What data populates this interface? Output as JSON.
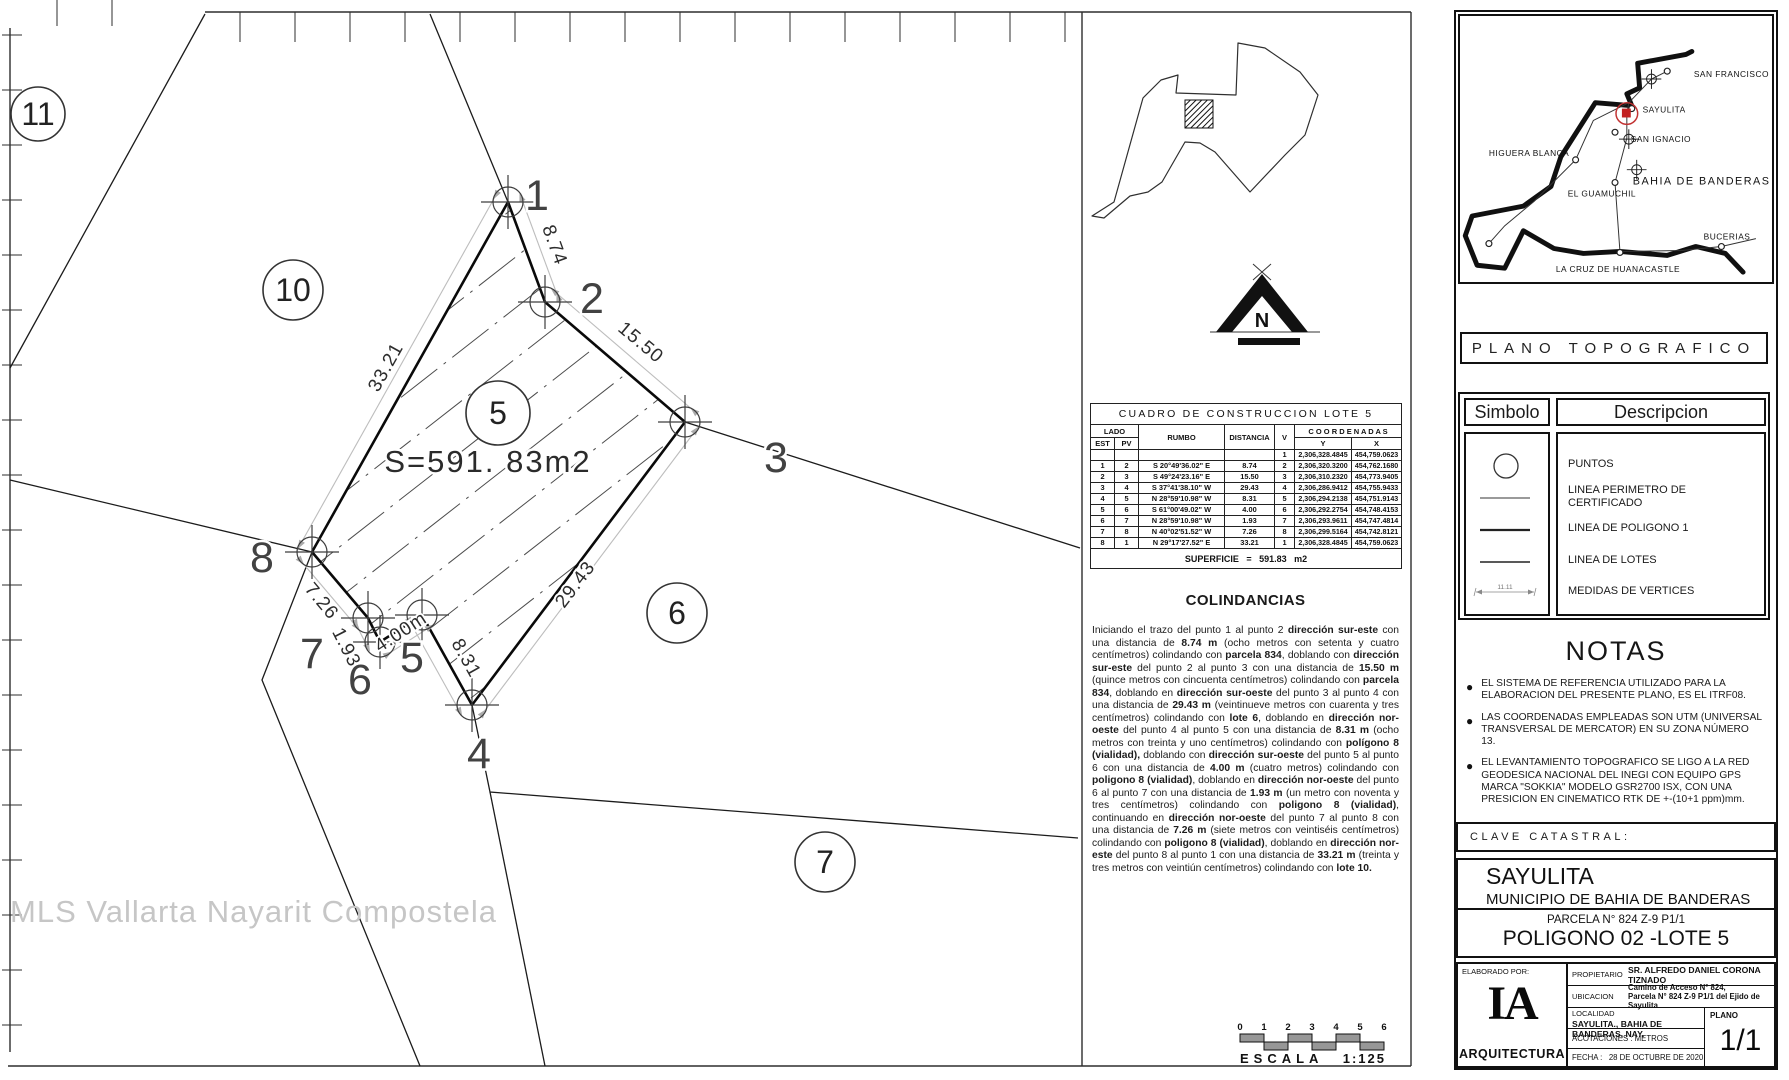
{
  "drawing": {
    "watermark": "MLS Vallarta Nayarit Compostela",
    "area_label": "S=591. 83m2",
    "area_label_pos": {
      "x": 488,
      "y": 472
    },
    "lot5_polygon": [
      [
        508,
        202
      ],
      [
        545,
        302
      ],
      [
        685,
        422
      ],
      [
        472,
        705
      ],
      [
        422,
        615
      ],
      [
        380,
        642
      ],
      [
        368,
        618
      ],
      [
        312,
        552
      ]
    ],
    "boundary_lines": [
      [
        [
          205,
          14
        ],
        [
          10,
          368
        ]
      ],
      [
        [
          430,
          14
        ],
        [
          508,
          202
        ]
      ],
      [
        [
          685,
          422
        ],
        [
          1080,
          548
        ]
      ],
      [
        [
          472,
          705
        ],
        [
          490,
          792
        ],
        [
          1078,
          838
        ]
      ],
      [
        [
          490,
          792
        ],
        [
          545,
          1066
        ]
      ],
      [
        [
          312,
          552
        ],
        [
          262,
          680
        ],
        [
          420,
          1066
        ]
      ],
      [
        [
          312,
          552
        ],
        [
          10,
          480
        ]
      ]
    ],
    "dim_lines": [
      [
        [
          521,
          197
        ],
        [
          558,
          297
        ]
      ],
      [
        [
          554,
          291
        ],
        [
          694,
          411
        ]
      ],
      [
        [
          696,
          430
        ],
        [
          483,
          713
        ]
      ],
      [
        [
          460,
          712
        ],
        [
          410,
          622
        ]
      ],
      [
        [
          430,
          627
        ],
        [
          388,
          654
        ]
      ],
      [
        [
          368,
          648
        ],
        [
          356,
          624
        ]
      ],
      [
        [
          357,
          627
        ],
        [
          301,
          561
        ]
      ],
      [
        [
          300,
          545
        ],
        [
          496,
          195
        ]
      ]
    ],
    "lot_circles": [
      {
        "label": "11",
        "x": 38,
        "y": 114,
        "r": 27
      },
      {
        "label": "10",
        "x": 293,
        "y": 290,
        "r": 30
      },
      {
        "label": "5",
        "x": 498,
        "y": 413,
        "r": 32
      },
      {
        "label": "6",
        "x": 677,
        "y": 613,
        "r": 30
      },
      {
        "label": "7",
        "x": 825,
        "y": 862,
        "r": 30
      }
    ],
    "vertex_labels": [
      {
        "label": "1",
        "x": 537,
        "y": 210
      },
      {
        "label": "2",
        "x": 592,
        "y": 313
      },
      {
        "label": "3",
        "x": 776,
        "y": 472
      },
      {
        "label": "4",
        "x": 479,
        "y": 768
      },
      {
        "label": "5",
        "x": 412,
        "y": 672
      },
      {
        "label": "6",
        "x": 360,
        "y": 694
      },
      {
        "label": "7",
        "x": 312,
        "y": 668
      },
      {
        "label": "8",
        "x": 262,
        "y": 572
      }
    ],
    "dim_labels": [
      {
        "label": "8.74",
        "x": 549,
        "y": 247,
        "rot": 70
      },
      {
        "label": "15.50",
        "x": 637,
        "y": 347,
        "rot": 40
      },
      {
        "label": "29.43",
        "x": 580,
        "y": 588,
        "rot": -53
      },
      {
        "label": "8.31",
        "x": 461,
        "y": 661,
        "rot": 61
      },
      {
        "label": "4.00m",
        "x": 404,
        "y": 637,
        "rot": -33
      },
      {
        "label": "1.93",
        "x": 341,
        "y": 650,
        "rot": 63
      },
      {
        "label": "7.26",
        "x": 317,
        "y": 605,
        "rot": 50
      },
      {
        "label": "33.21",
        "x": 391,
        "y": 370,
        "rot": -61
      }
    ]
  },
  "locator": {
    "polygon": [
      [
        1092,
        216
      ],
      [
        1114,
        202
      ],
      [
        1143,
        98
      ],
      [
        1161,
        80
      ],
      [
        1178,
        75
      ],
      [
        1176,
        93
      ],
      [
        1236,
        95
      ],
      [
        1238,
        43
      ],
      [
        1265,
        48
      ],
      [
        1300,
        72
      ],
      [
        1318,
        95
      ],
      [
        1305,
        135
      ],
      [
        1285,
        155
      ],
      [
        1250,
        192
      ],
      [
        1215,
        152
      ],
      [
        1200,
        143
      ],
      [
        1185,
        142
      ],
      [
        1162,
        182
      ],
      [
        1148,
        192
      ],
      [
        1130,
        196
      ],
      [
        1104,
        218
      ]
    ],
    "square": [
      1185,
      100,
      28
    ]
  },
  "north": {
    "label": "N"
  },
  "construction_table": {
    "title": "CUADRO DE CONSTRUCCION LOTE 5",
    "headers": {
      "lado": "LADO",
      "est": "EST",
      "pv": "PV",
      "rumbo": "RUMBO",
      "distancia": "DISTANCIA",
      "v": "V",
      "coordenadas": "C O O R D E N A D A S",
      "y": "Y",
      "x": "X"
    },
    "rows": [
      {
        "est": "",
        "pv": "",
        "rumbo": "",
        "dist": "",
        "v": "1",
        "y": "2,306,328.4845",
        "x": "454,759.0623"
      },
      {
        "est": "1",
        "pv": "2",
        "rumbo": "S 20°49'36.02\" E",
        "dist": "8.74",
        "v": "2",
        "y": "2,306,320.3200",
        "x": "454,762.1680"
      },
      {
        "est": "2",
        "pv": "3",
        "rumbo": "S 49°24'23.16\" E",
        "dist": "15.50",
        "v": "3",
        "y": "2,306,310.2320",
        "x": "454,773.9405"
      },
      {
        "est": "3",
        "pv": "4",
        "rumbo": "S 37°41'38.10\" W",
        "dist": "29.43",
        "v": "4",
        "y": "2,306,286.9412",
        "x": "454,755.9433"
      },
      {
        "est": "4",
        "pv": "5",
        "rumbo": "N 28°59'10.98\" W",
        "dist": "8.31",
        "v": "5",
        "y": "2,306,294.2138",
        "x": "454,751.9143"
      },
      {
        "est": "5",
        "pv": "6",
        "rumbo": "S 61°00'49.02\" W",
        "dist": "4.00",
        "v": "6",
        "y": "2,306,292.2754",
        "x": "454,748.4153"
      },
      {
        "est": "6",
        "pv": "7",
        "rumbo": "N 28°59'10.98\" W",
        "dist": "1.93",
        "v": "7",
        "y": "2,306,293.9611",
        "x": "454,747.4814"
      },
      {
        "est": "7",
        "pv": "8",
        "rumbo": "N 40°02'51.52\" W",
        "dist": "7.26",
        "v": "8",
        "y": "2,306,299.5164",
        "x": "454,742.8121"
      },
      {
        "est": "8",
        "pv": "1",
        "rumbo": "N 29°17'27.52\" E",
        "dist": "33.21",
        "v": "1",
        "y": "2,306,328.4845",
        "x": "454,759.0623"
      }
    ],
    "superficie": "SUPERFICIE = 591.83 m2"
  },
  "colindancias": {
    "title": "COLINDANCIAS",
    "segments": [
      {
        "t": "Iniciando el trazo del punto 1 al punto 2 "
      },
      {
        "t": "dirección sur-este",
        "b": 1
      },
      {
        "t": " con una distancia de "
      },
      {
        "t": "8.74 m",
        "b": 1
      },
      {
        "t": " (ocho metros con setenta y cuatro centímetros) colindando con "
      },
      {
        "t": "parcela 834",
        "b": 1
      },
      {
        "t": ", doblando con "
      },
      {
        "t": "dirección sur-este",
        "b": 1
      },
      {
        "t": " del punto 2 al punto 3 con una distancia de "
      },
      {
        "t": "15.50 m",
        "b": 1
      },
      {
        "t": " (quince metros con cincuenta centímetros) colindando con "
      },
      {
        "t": "parcela 834",
        "b": 1
      },
      {
        "t": ", doblando en "
      },
      {
        "t": "dirección sur-oeste",
        "b": 1
      },
      {
        "t": " del punto 3 al punto 4 con una distancia de "
      },
      {
        "t": "29.43 m",
        "b": 1
      },
      {
        "t": " (veintinueve metros con cuarenta y tres centímetros) colindando con "
      },
      {
        "t": "lote 6",
        "b": 1
      },
      {
        "t": ", doblando en "
      },
      {
        "t": "dirección nor-oeste",
        "b": 1
      },
      {
        "t": " del punto 4 al punto 5 con una distancia de "
      },
      {
        "t": "8.31 m",
        "b": 1
      },
      {
        "t": " (ocho metros con treinta y uno centímetros) colindando con "
      },
      {
        "t": "polígono 8 (vialidad),",
        "b": 1
      },
      {
        "t": " doblando con "
      },
      {
        "t": "dirección sur-oeste",
        "b": 1
      },
      {
        "t": " del punto 5 al punto 6 con una distancia de "
      },
      {
        "t": "4.00 m",
        "b": 1
      },
      {
        "t": " (cuatro metros) colindando con "
      },
      {
        "t": "poligono 8 (vialidad)",
        "b": 1
      },
      {
        "t": ", doblando en "
      },
      {
        "t": "dirección nor-oeste",
        "b": 1
      },
      {
        "t": " del punto 6 al punto 7 con una distancia de "
      },
      {
        "t": "1.93 m",
        "b": 1
      },
      {
        "t": " (un metro con noventa y tres centímetros) colindando con "
      },
      {
        "t": "poligono 8 (vialidad)",
        "b": 1
      },
      {
        "t": ", continuando en "
      },
      {
        "t": "dirección nor-oeste",
        "b": 1
      },
      {
        "t": " del punto 7 al punto 8 con una distancia de "
      },
      {
        "t": "7.26 m",
        "b": 1
      },
      {
        "t": " (siete metros con veintiséis centímetros) colindando con "
      },
      {
        "t": "poligono 8 (vialidad)",
        "b": 1
      },
      {
        "t": ", doblando en "
      },
      {
        "t": "dirección nor-este",
        "b": 1
      },
      {
        "t": " del punto 8 al punto 1 con una distancia de "
      },
      {
        "t": "33.21 m",
        "b": 1
      },
      {
        "t": " (treinta y tres metros con veintiún centímetros) colindando con "
      },
      {
        "t": "lote 10.",
        "b": 1
      }
    ]
  },
  "scale_bar": {
    "ticks": [
      "0",
      "1",
      "2",
      "3",
      "4",
      "5",
      "6"
    ],
    "escala": "ESCALA",
    "ratio": "1:125"
  },
  "right_panel": {
    "plano_title": "PLANO TOPOGRAFICO",
    "map": {
      "coast": [
        [
          240,
          38
        ],
        [
          234,
          41
        ],
        [
          185,
          50
        ],
        [
          187,
          75
        ],
        [
          174,
          81
        ],
        [
          179,
          93
        ],
        [
          142,
          90
        ],
        [
          107,
          145
        ],
        [
          97,
          175
        ],
        [
          69,
          195
        ],
        [
          17,
          205
        ],
        [
          10,
          225
        ],
        [
          22,
          255
        ],
        [
          50,
          258
        ],
        [
          69,
          220
        ],
        [
          100,
          238
        ],
        [
          130,
          243
        ],
        [
          167,
          241
        ],
        [
          215,
          245
        ],
        [
          244,
          236
        ],
        [
          274,
          243
        ],
        [
          292,
          262
        ]
      ],
      "roads": [
        [
          [
            215,
            58
          ],
          [
            199,
            66
          ],
          [
            176,
            90
          ],
          [
            174,
            101
          ],
          [
            174,
            126
          ],
          [
            162,
            171
          ],
          [
            167,
            241
          ]
        ],
        [
          [
            167,
            241
          ],
          [
            230,
            240
          ],
          [
            270,
            236
          ],
          [
            305,
            228
          ]
        ],
        [
          [
            176,
            90
          ],
          [
            140,
            108
          ],
          [
            122,
            148
          ],
          [
            80,
            190
          ],
          [
            50,
            215
          ],
          [
            34,
            233
          ]
        ]
      ],
      "points": [
        [
          215,
          58
        ],
        [
          179,
          96
        ],
        [
          162,
          120
        ],
        [
          122,
          148
        ],
        [
          162,
          171
        ],
        [
          270,
          236
        ],
        [
          167,
          242
        ],
        [
          34,
          233
        ]
      ],
      "crosshairs": [
        [
          199,
          66
        ],
        [
          176,
          127
        ],
        [
          184,
          158
        ]
      ],
      "red_marker": {
        "x": 174,
        "y": 101
      },
      "towns": [
        {
          "name": "SAN FRANCISCO",
          "lx": 242,
          "ly": 64
        },
        {
          "name": "SAYULITA",
          "lx": 190,
          "ly": 100
        },
        {
          "name": "SAN IGNACIO",
          "lx": 178,
          "ly": 130
        },
        {
          "name": "HIGUERA BLANCA",
          "lx": 34,
          "ly": 144
        },
        {
          "name": "BAHIA DE BANDERAS",
          "lx": 180,
          "ly": 173,
          "big": true
        },
        {
          "name": "EL GUAMUCHIL",
          "lx": 114,
          "ly": 185
        },
        {
          "name": "BUCERIAS",
          "lx": 252,
          "ly": 229
        },
        {
          "name": "LA CRUZ DE HUANACASTLE",
          "lx": 102,
          "ly": 262
        },
        {
          "name": "PUNTA DE MITA",
          "lx": 8,
          "ly": 279
        }
      ]
    },
    "legend": {
      "simbolo": "Simbolo",
      "descripcion": "Descripcion",
      "items": [
        {
          "desc": "PUNTOS",
          "sym": "circle"
        },
        {
          "desc": "LINEA PERIMETRO DE CERTIFICADO",
          "sym": "line-light"
        },
        {
          "desc": "LINEA DE POLIGONO 1",
          "sym": "line-dark"
        },
        {
          "desc": "LINEA DE LOTES",
          "sym": "line-med"
        },
        {
          "desc": "MEDIDAS DE VERTICES",
          "sym": "measure",
          "measure_label": "11.11"
        }
      ]
    },
    "notas": {
      "title": "NOTAS",
      "items": [
        "EL SISTEMA DE REFERENCIA UTILIZADO PARA LA ELABORACION DEL PRESENTE PLANO, ES EL ITRF08.",
        "LAS COORDENADAS EMPLEADAS SON UTM (UNIVERSAL TRANSVERSAL DE MERCATOR) EN SU ZONA NÚMERO 13.",
        "EL  LEVANTAMIENTO TOPOGRAFICO SE LIGO A LA RED GEODESICA NACIONAL DEL INEGI CON EQUIPO GPS MARCA  \"SOKKIA\"  MODELO GSR2700 ISX, CON UNA PRESICION EN CINEMATICO RTK DE +-(10+1 ppm)mm."
      ]
    },
    "clave": "CLAVE  CATASTRAL:",
    "location_block": {
      "line1": "SAYULITA",
      "line2": "MUNICIPIO DE BAHIA DE BANDERAS",
      "line3": "PARCELA N° 824 Z-9 P1/1",
      "line4": "POLIGONO 02 -LOTE 5"
    },
    "title_block": {
      "elaborado": "ELABORADO POR:",
      "logo_main": "IA",
      "logo_sub": "ARQUITECTURA",
      "prop_label": "PROPIETARIO",
      "prop_value": "SR. ALFREDO DANIEL CORONA TIZNADO",
      "ubi_label": "UBICACION",
      "ubi_value1": "Camino de Acceso N° 824,",
      "ubi_value2": "Parcela N° 824 Z-9 P1/1 del Ejido de Sayulita",
      "loc_label": "LOCALIDAD",
      "loc_value": "SAYULITA., BAHIA DE BANDERAS, NAY.",
      "acot": "ACOTACIONES : METROS",
      "fecha_label": "FECHA :",
      "fecha_value": "28 DE OCTUBRE DE 2020",
      "plano_label": "PLANO",
      "plano_value": "1/1"
    }
  }
}
